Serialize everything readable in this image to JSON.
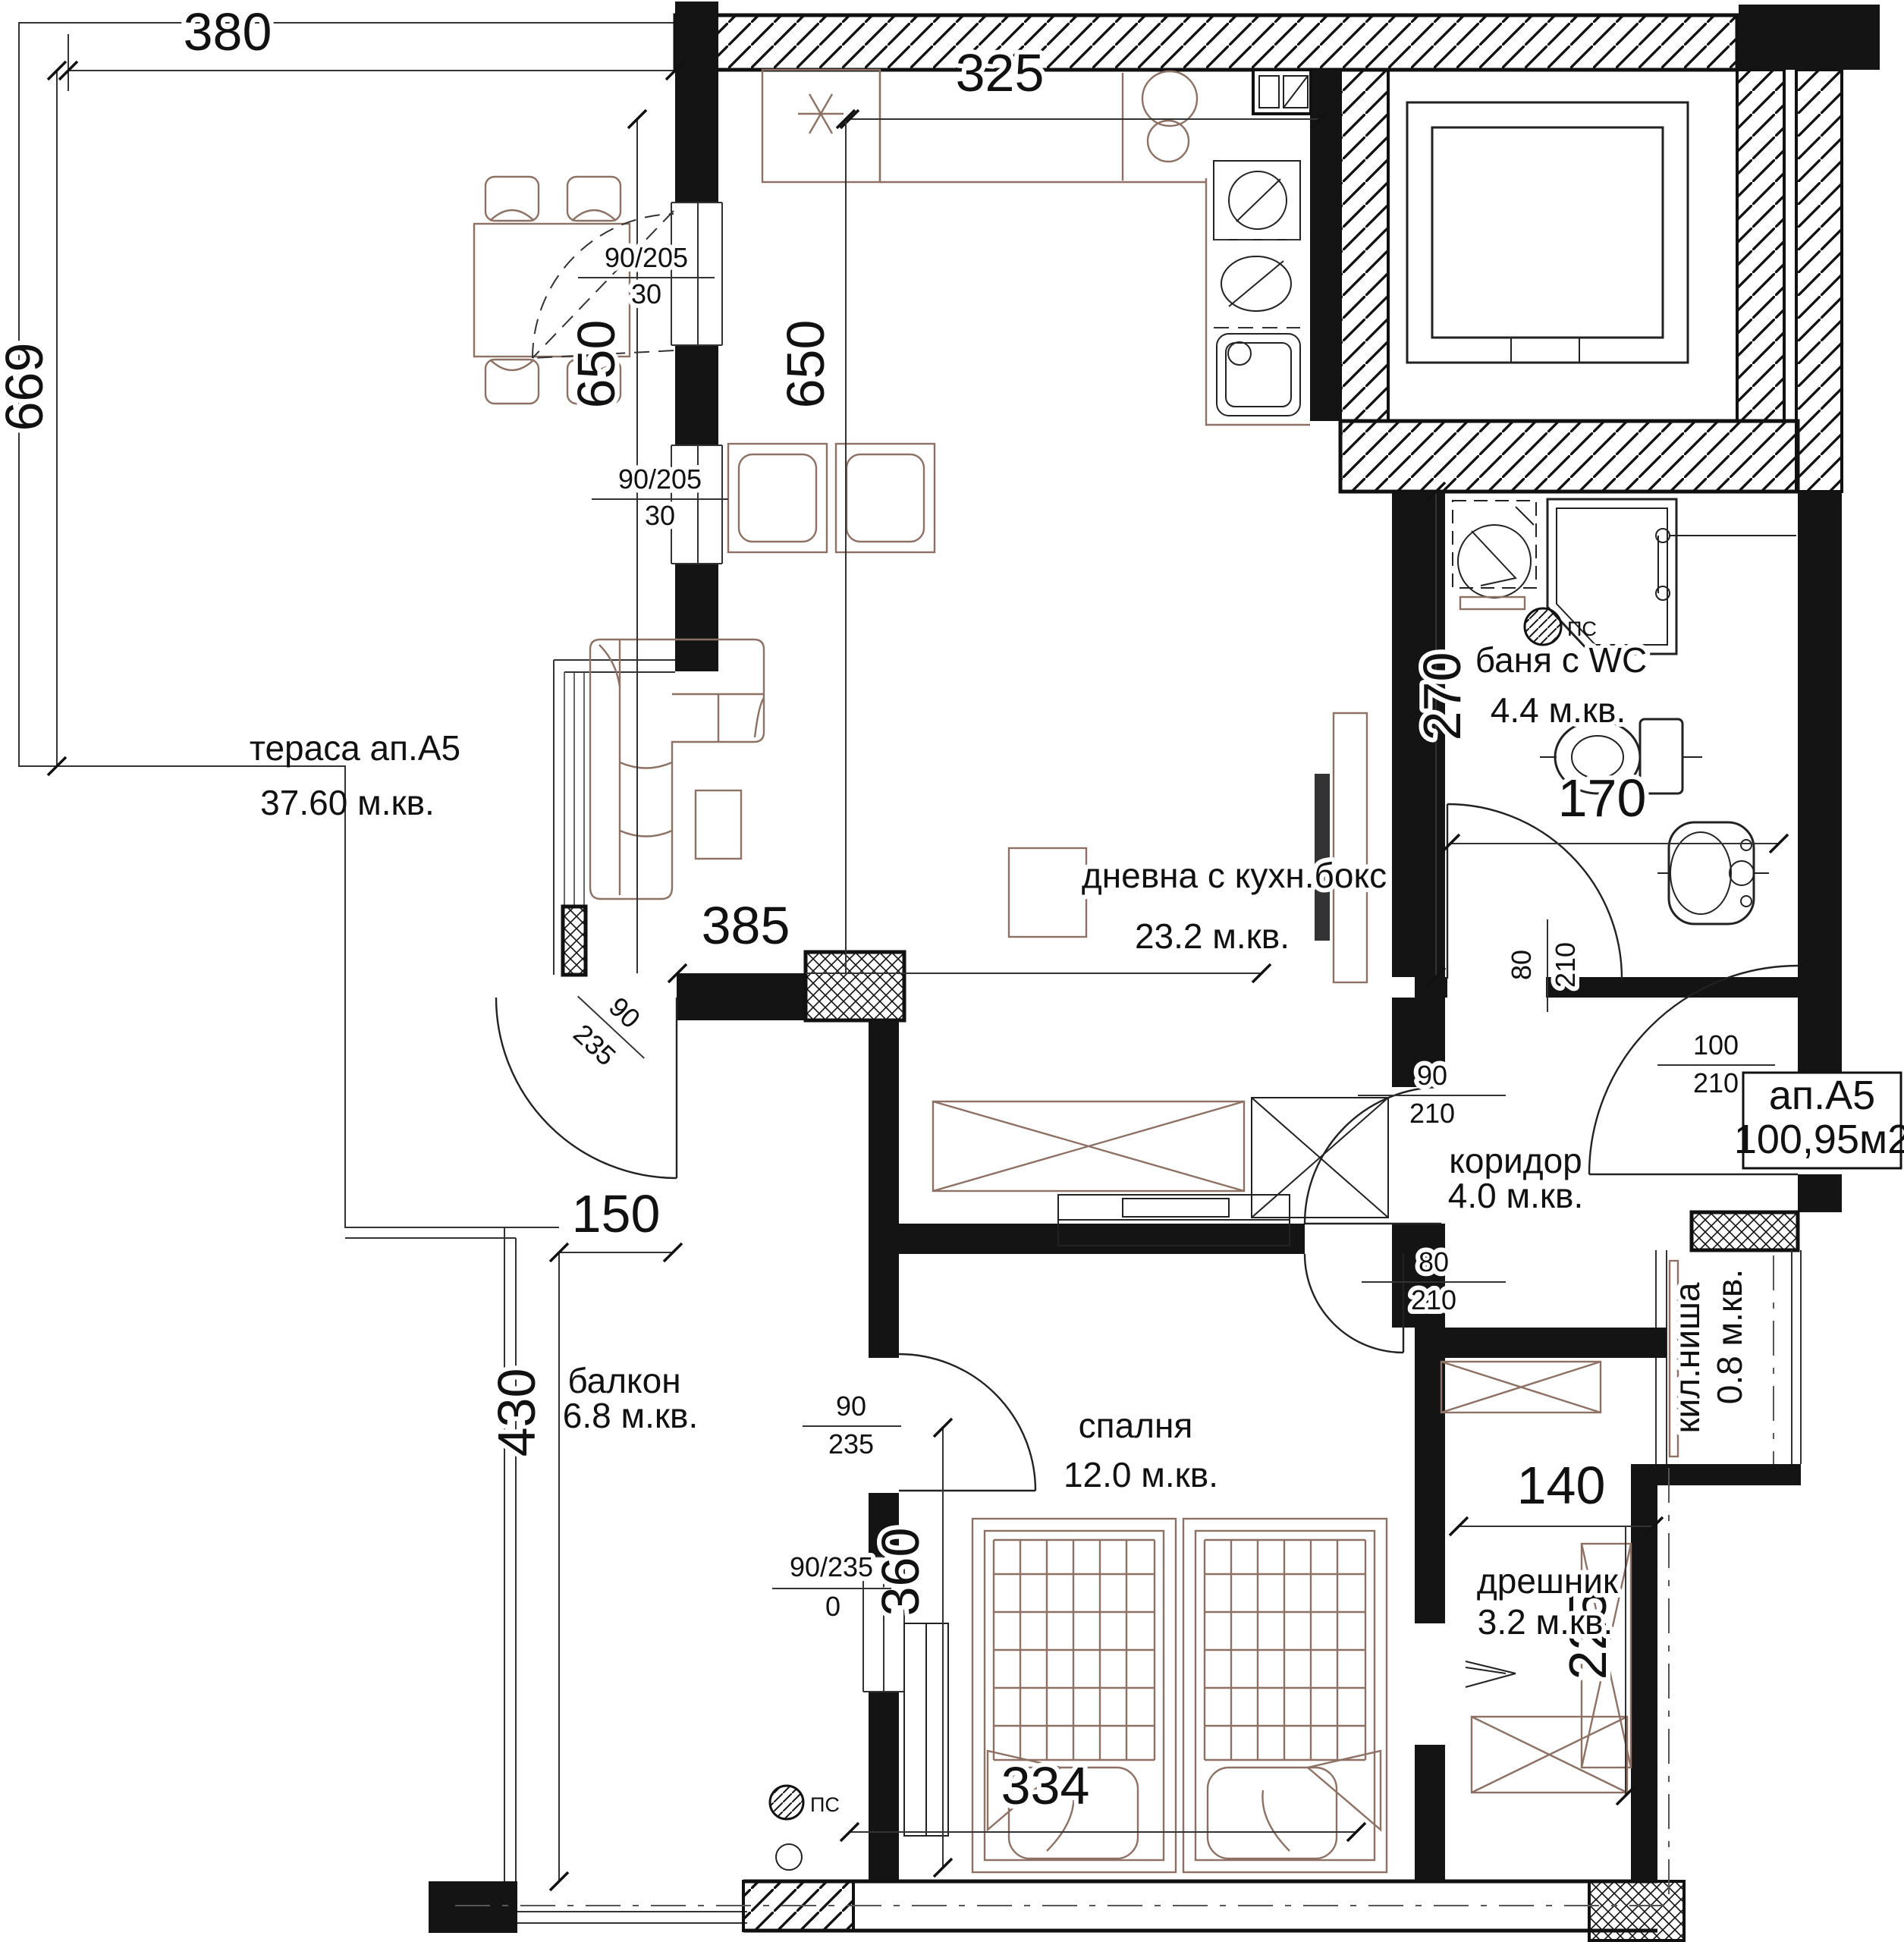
{
  "plan": {
    "rooms": {
      "terrace": {
        "name": "тераса  ап.А5",
        "area": "37.60 м.кв."
      },
      "living": {
        "name": "дневна с кухн.бокс",
        "area": "23.2 м.кв."
      },
      "bath": {
        "name": "баня с WC",
        "area": "4.4 м.кв."
      },
      "corridor": {
        "name": "коридор",
        "area": "4.0 м.кв."
      },
      "niche": {
        "name": "кил.ниша",
        "area": "0.8 м.кв."
      },
      "balcony": {
        "name": "балкон",
        "area": "6.8 м.кв."
      },
      "bedroom": {
        "name": "спалня",
        "area": "12.0 м.кв."
      },
      "closet": {
        "name": "дрешник",
        "area": "3.2 м.кв."
      }
    },
    "badge": {
      "unit": "ап.А5",
      "area": "100,95м2"
    },
    "dims": {
      "terrace_w": "380",
      "terrace_h": "669",
      "kitchen_w": "325",
      "living_h1": "650",
      "living_h2": "650",
      "living_w": "385",
      "bath_h": "270",
      "bath_w": "170",
      "balcony_w": "150",
      "balcony_h": "430",
      "bedroom_wall": "360",
      "bed_w": "334",
      "closet_w": "140",
      "closet_h": "225"
    },
    "doors": {
      "win1": {
        "n": "90/205",
        "d": "30"
      },
      "win2": {
        "n": "90/205",
        "d": "30"
      },
      "living_balcony": {
        "n": "90",
        "d": "235"
      },
      "living_corridor": {
        "n": "90",
        "d": "210"
      },
      "bath": {
        "n": "80",
        "d": "210"
      },
      "bedroom": {
        "n": "80",
        "d": "210"
      },
      "entry": {
        "n": "100",
        "d": "210"
      },
      "balcony_bedroom": {
        "n": "90",
        "d": "235"
      },
      "bedroom_window": {
        "n": "90/235",
        "d": "0"
      }
    },
    "symbols": {
      "ps": "ПС"
    },
    "colors": {
      "wall": "#141414",
      "furniture": "#8d7164",
      "line": "#333333"
    }
  }
}
